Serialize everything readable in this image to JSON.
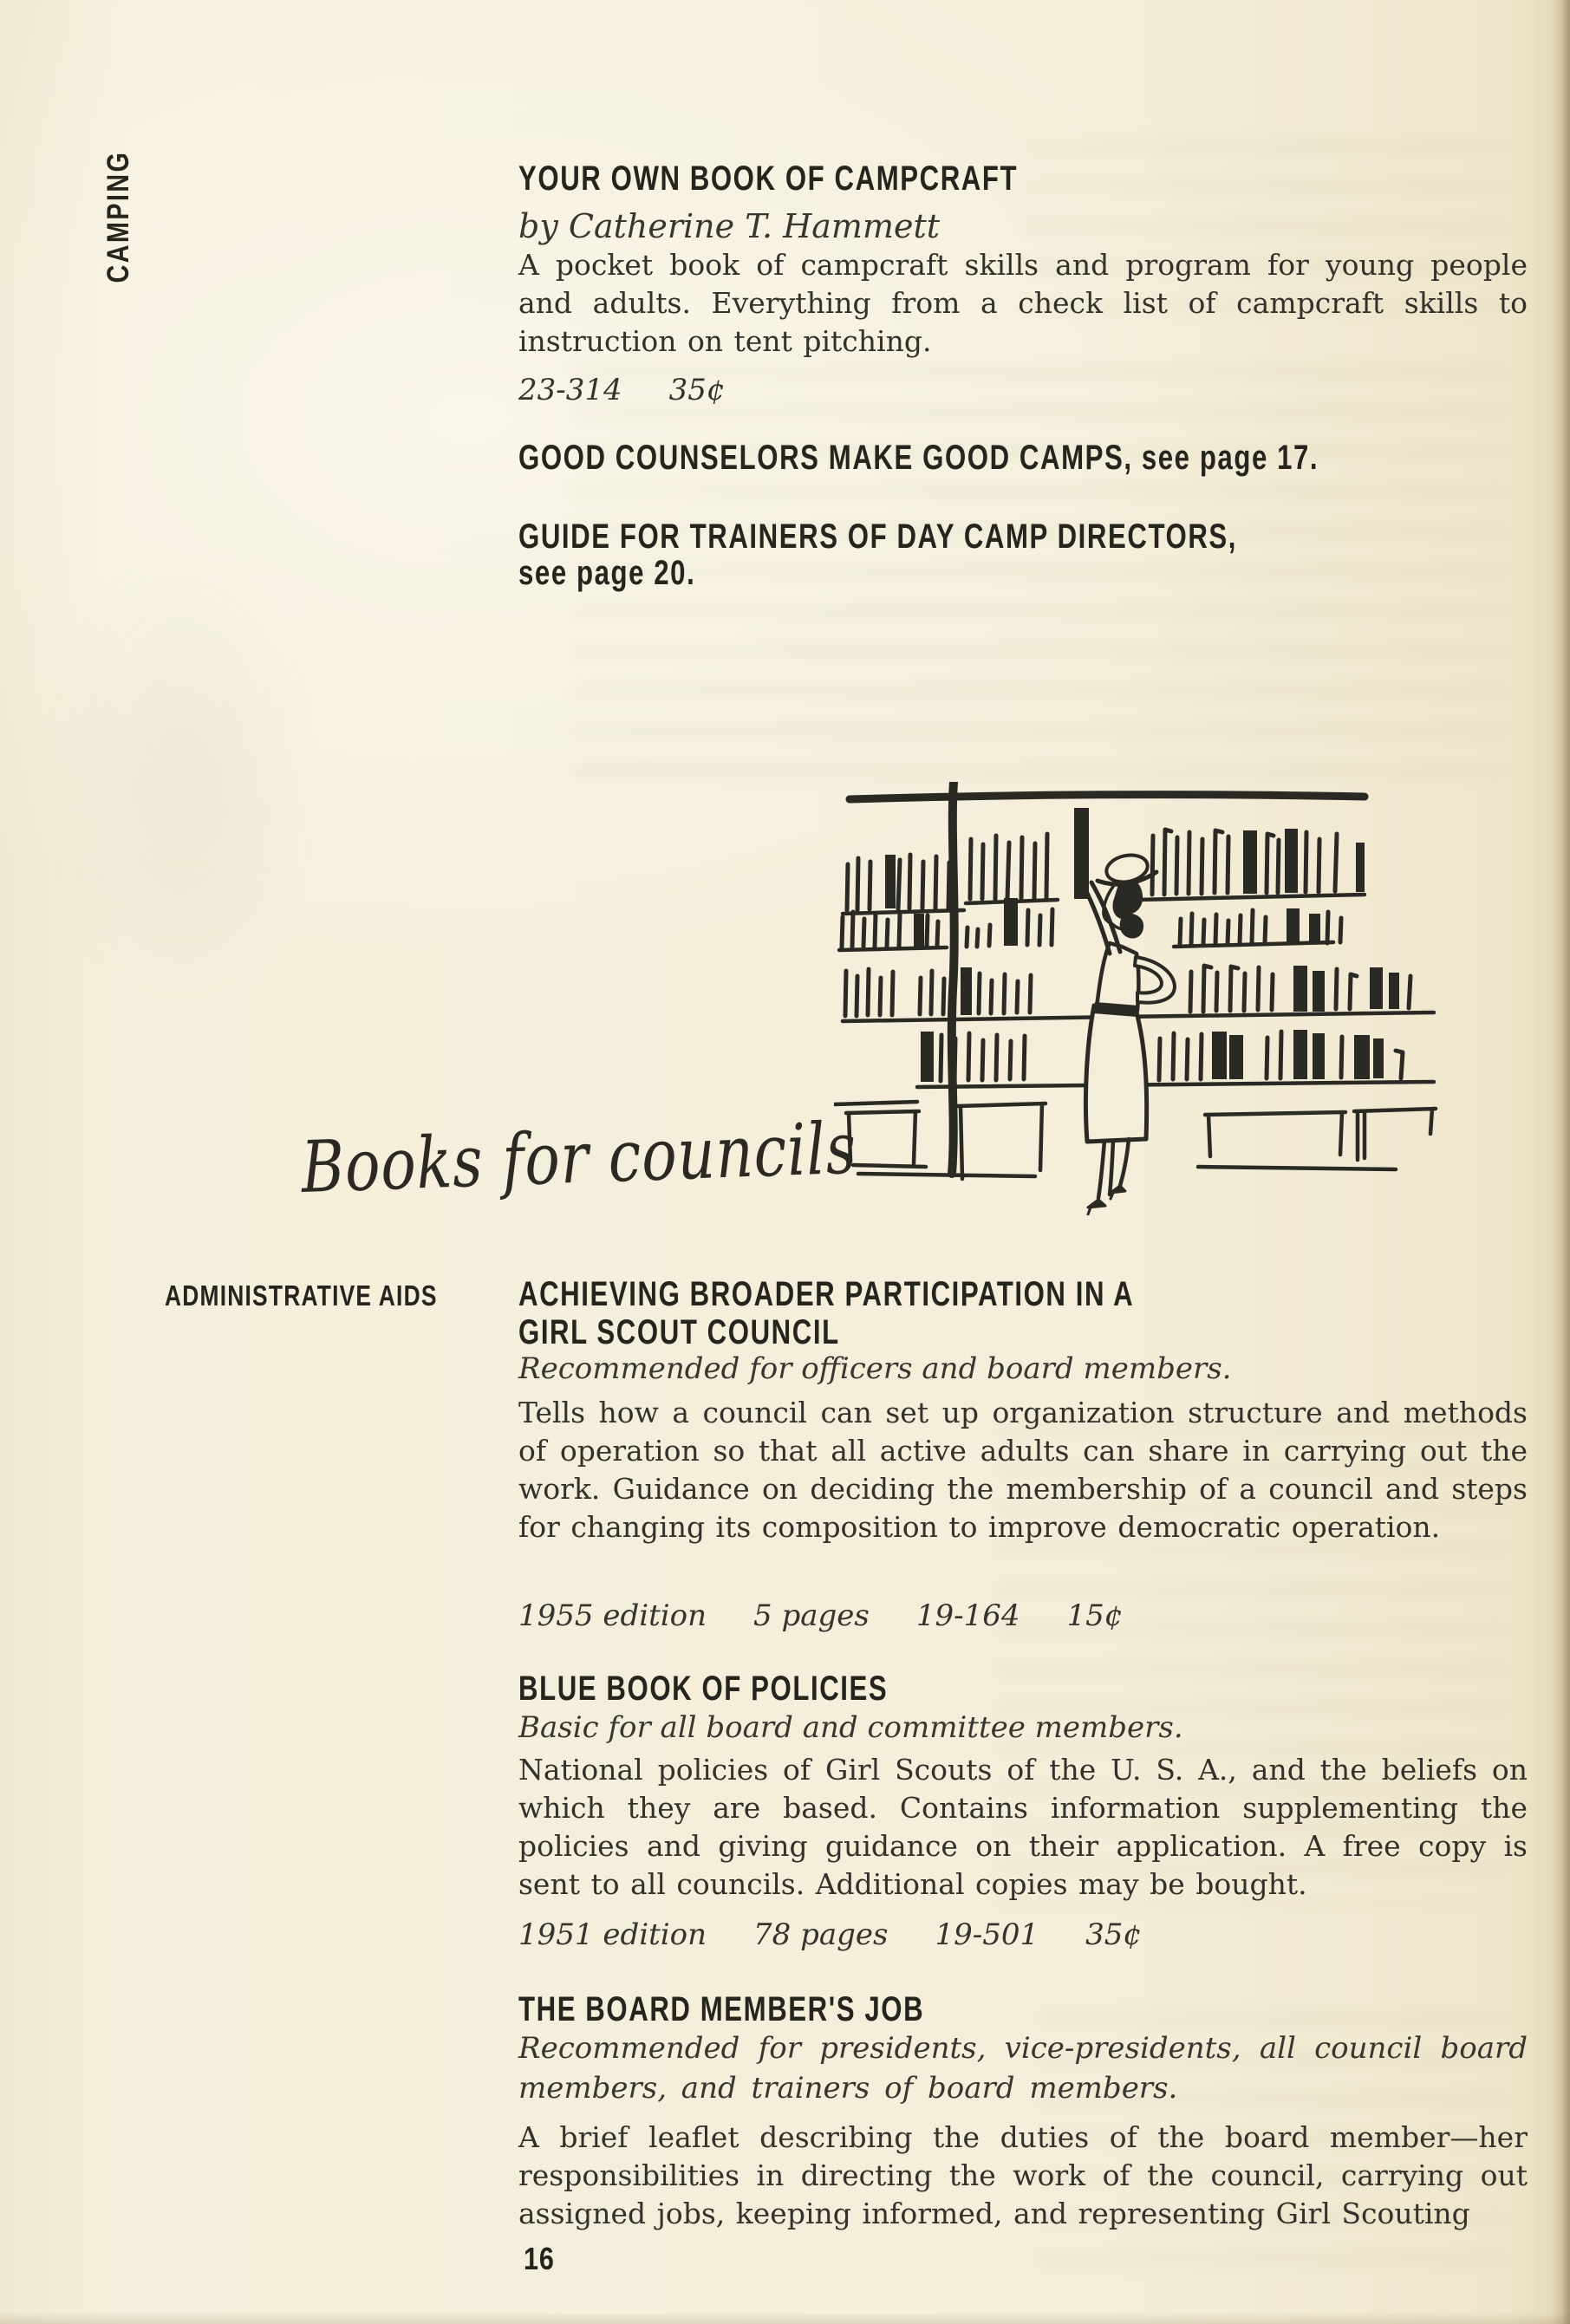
{
  "colors": {
    "paper": "#f3edd9",
    "ink": "#2a2923",
    "heading_ink": "#25241d"
  },
  "page": {
    "number": "16",
    "sidebar_label": "CAMPING"
  },
  "camping_section": {
    "book": {
      "title": "YOUR OWN BOOK OF CAMPCRAFT",
      "byline": "by Catherine T. Hammett",
      "description": "A pocket book of campcraft skills and program for young people and adults. Everything from a check list of campcraft skills to instruction on tent pitching.",
      "catalog_number": "23-314",
      "price": "35¢"
    },
    "cross_ref_1": "GOOD COUNSELORS MAKE GOOD CAMPS, see page 17.",
    "cross_ref_2_line1": "GUIDE FOR TRAINERS OF DAY CAMP DIRECTORS,",
    "cross_ref_2_line2": "see page 20."
  },
  "councils_section": {
    "script_heading": "Books for councils",
    "category_label": "ADMINISTRATIVE AIDS",
    "books": [
      {
        "title_line1": "ACHIEVING BROADER PARTICIPATION IN A",
        "title_line2": "GIRL SCOUT COUNCIL",
        "audience": "Recommended for officers and board members.",
        "description": "Tells how a council can set up organization structure and methods of operation so that all active adults can share in carrying out the work. Guidance on deciding the membership of a council and steps for changing its composition to improve democratic operation.",
        "edition": "1955 edition",
        "pages": "5 pages",
        "catalog_number": "19-164",
        "price": "15¢"
      },
      {
        "title_line1": "BLUE BOOK OF POLICIES",
        "audience": "Basic for all board and committee members.",
        "description": "National policies of Girl Scouts of the U. S. A., and the beliefs on which they are based. Contains information supplementing the policies and giving guidance on their application. A free copy is sent to all councils. Additional copies may be bought.",
        "edition": "1951 edition",
        "pages": "78 pages",
        "catalog_number": "19-501",
        "price": "35¢"
      },
      {
        "title_line1": "THE BOARD MEMBER'S JOB",
        "audience": "Recommended for presidents, vice-presidents, all council board members, and trainers of board members.",
        "description": "A brief leaflet describing the duties of the board member—her responsibilities in directing the work of the council, carrying out assigned jobs, keeping informed, and representing Girl Scouting"
      }
    ]
  }
}
